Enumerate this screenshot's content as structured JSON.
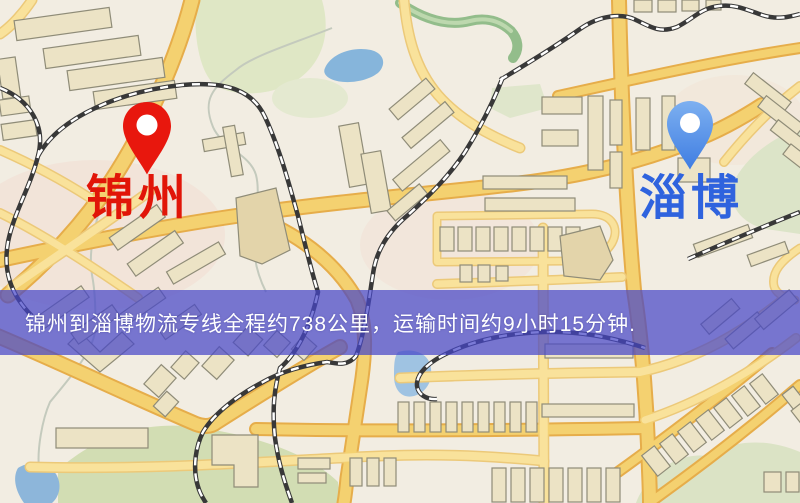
{
  "banner": {
    "text": "锦州到淄博物流专线全程约738公里，运输时间约9小时15分钟.",
    "origin_city": "锦州",
    "destination_city": "淄博",
    "distance_text": "约738公里",
    "duration_text": "约9小时15分钟",
    "background_color": "#4646c8",
    "text_color": "#ffffff"
  },
  "markers": {
    "origin": {
      "label": "锦州",
      "pin_color": "#e8170d",
      "label_color": "#e11508"
    },
    "destination": {
      "label": "淄博",
      "pin_color": "#5694ec",
      "label_color": "#2f63de"
    }
  },
  "map_palette": {
    "background": "#f2ede2",
    "road_major": "#f4d170",
    "road_major_casing": "#e6ad4a",
    "road_minor": "#f9e29b",
    "building": "#ece3c5",
    "building_outline": "#8f8c78",
    "park": "#dfe7c5",
    "water": "#86b5db",
    "railway": "#383838"
  }
}
